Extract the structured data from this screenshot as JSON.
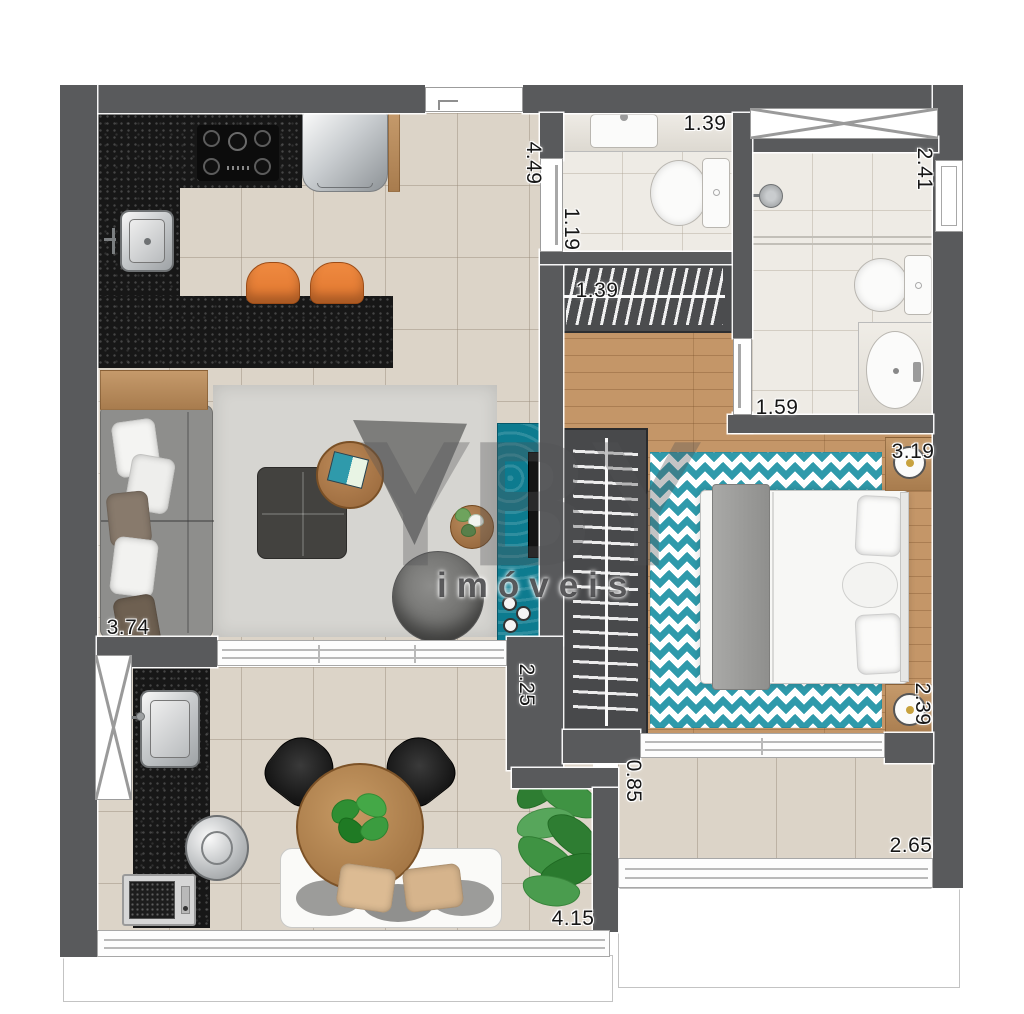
{
  "watermark": {
    "brand": "YBY",
    "subtitle": "imóveis"
  },
  "dimensions": {
    "entry_hall_height": "4.49",
    "bath1_width": "1.39",
    "bath2_length": "2.41",
    "bath1_length": "1.19",
    "hall_closet_width": "1.39",
    "bath2_width": "1.59",
    "bedroom_length": "3.19",
    "living_length": "3.74",
    "terrace_depth": "2.25",
    "bedroom_width": "2.39",
    "balcony_depth": "0.85",
    "balcony_width": "2.65",
    "terrace_width": "4.15"
  },
  "colors": {
    "wall": "#595a5c",
    "granite": "#171717",
    "tile": "#dcd4c8",
    "wood": "#c49668",
    "bathfloor": "#eeebe5",
    "teal": "#0d7b8f",
    "chevron": "#2f9aab",
    "orange": "#e0762f",
    "rug": "#d6d5d1",
    "sofa": "#8e8e8c"
  }
}
